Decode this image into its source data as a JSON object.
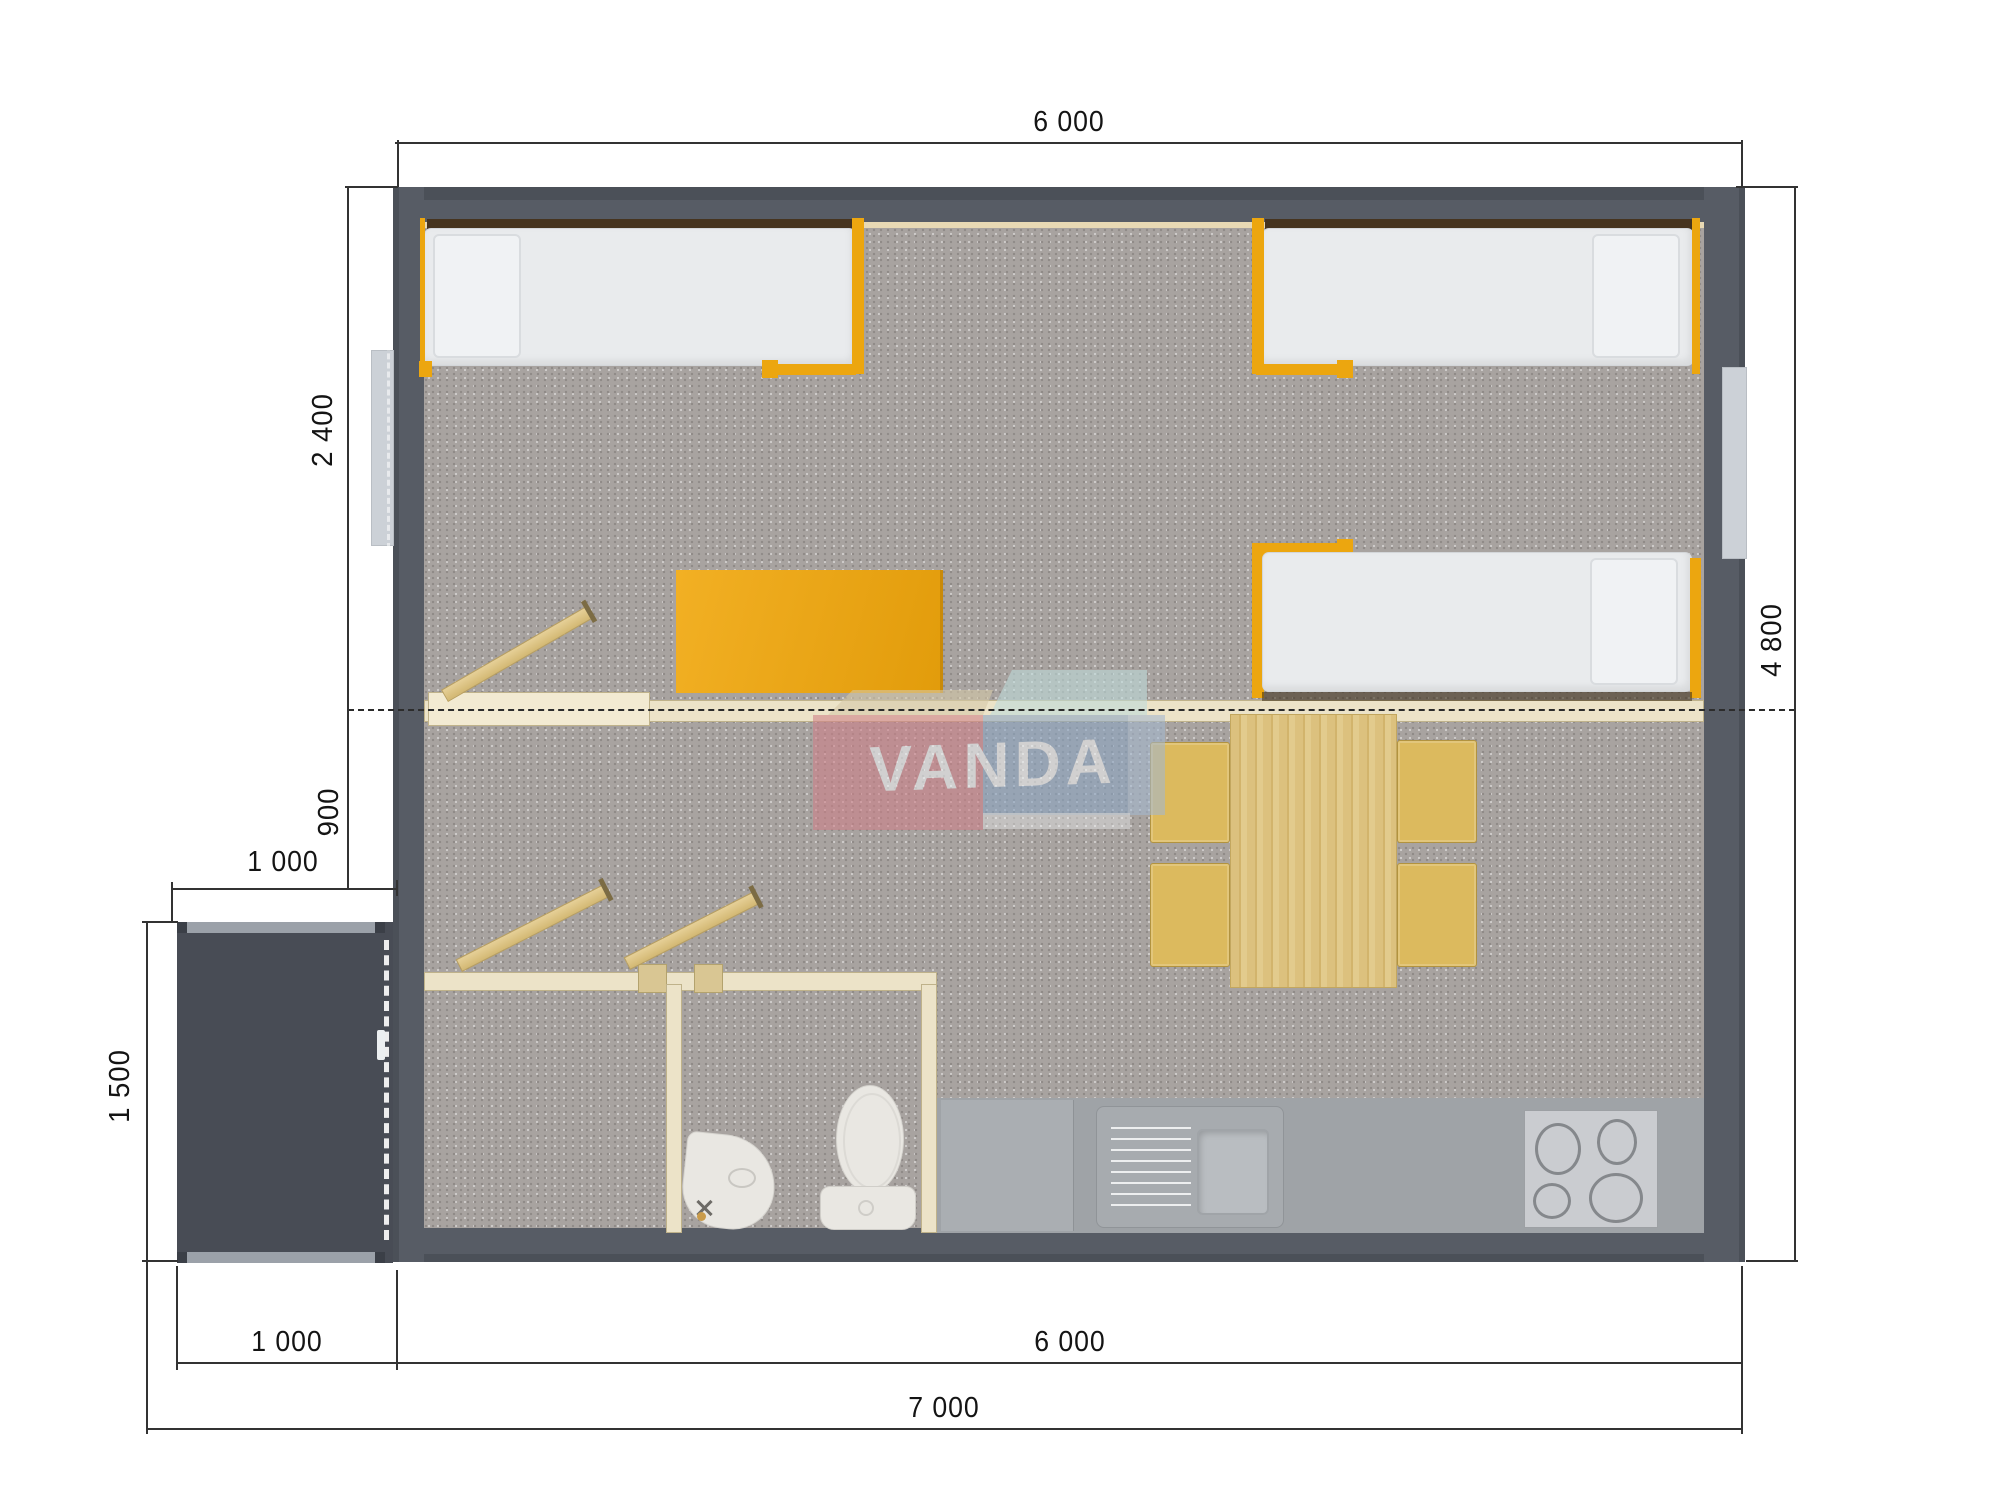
{
  "watermark": {
    "text": "VANDA"
  },
  "dimensions": {
    "top_width": "6 000",
    "right_height": "4 800",
    "left_bedroom_depth": "2 400",
    "left_hall_depth": "900",
    "porch_width": "1 000",
    "porch_depth": "1 500",
    "bottom_porch_width": "1 000",
    "bottom_house_width": "6 000",
    "bottom_total_width": "7 000"
  },
  "colors": {
    "wall": "#575c65",
    "wallEdge": "#4b5058",
    "floor": "#a8a3a0",
    "floorDot": "#8f8a87",
    "accent": "#eca60f",
    "cream": "#ece3c8",
    "creamLine": "#bfb28a",
    "liner": "#e8d9b4",
    "headboard": "#46341f",
    "bedWhite": "#e9ebed",
    "porch": "#484c55",
    "porchStrip": "#9ba1a9",
    "wood": "#dcc07d",
    "woodEdge": "#b99f5e",
    "chair": "#dcba5e",
    "counter": "#9fa3a7",
    "counterLight": "#aaaeb2",
    "applianceLight": "#caccd0",
    "porcelain": "#e9e7e2",
    "dim": "#333333",
    "logoPink": "#cf8088",
    "logoBlue": "#8ba5c3",
    "logoBlueTop": "#bfdcdc",
    "logoCream": "#d6c9a8"
  }
}
